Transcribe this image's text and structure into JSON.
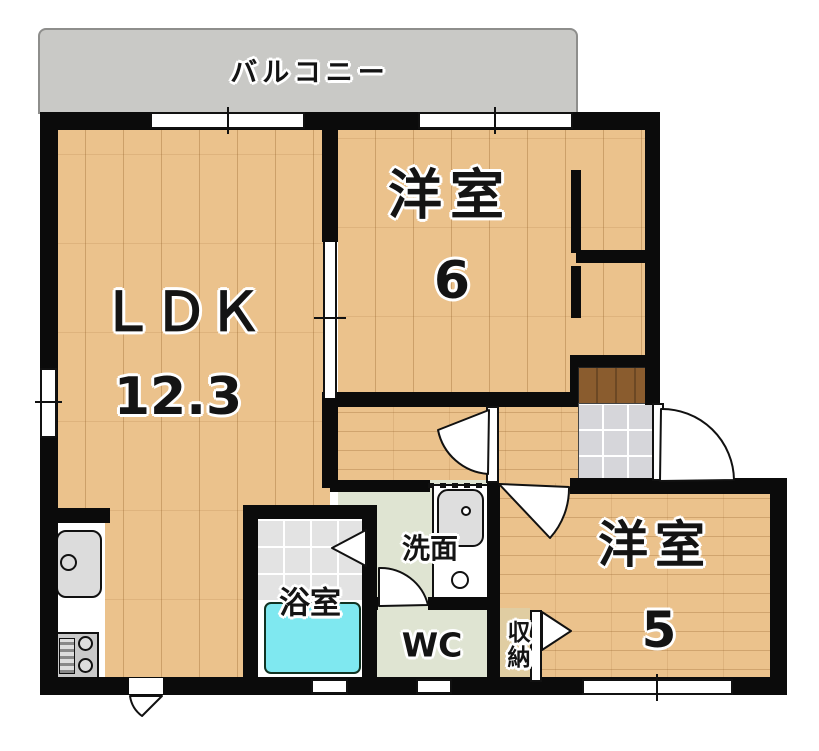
{
  "plan_title": "2LDK apartment floor plan",
  "balcony": {
    "label": "バルコニー"
  },
  "rooms": {
    "ldk": {
      "label": "ＬＤＫ",
      "size": "12.3"
    },
    "western6": {
      "label": "洋室",
      "size": "6"
    },
    "western5": {
      "label": "洋室",
      "size": "5"
    },
    "bath": {
      "label": "浴室"
    },
    "washroom": {
      "label": "洗面"
    },
    "wc": {
      "label": "WC"
    },
    "storage": {
      "label": "収納"
    }
  },
  "colors": {
    "wood": "#ebc28c",
    "wall": "#0b0b0b",
    "balcony": "#c9c9c6",
    "service_floor": "#dfe4d2",
    "bath_tile": "#e3e3e3",
    "genkan_tile": "#d6d6da",
    "step": "#8a5c2e",
    "tub": "#7fe8f0",
    "storage_floor": "#e0cda2"
  }
}
